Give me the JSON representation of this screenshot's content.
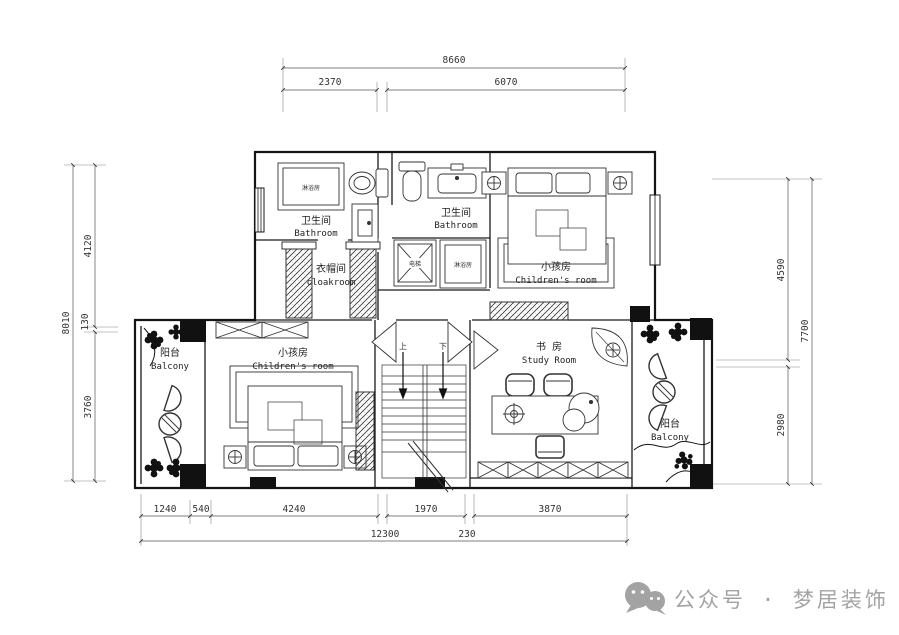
{
  "dims": {
    "top_total": "8660",
    "top_seg1": "2370",
    "top_seg2": "6070",
    "left_total": "8010",
    "left_seg1": "4120",
    "left_seg2": "130",
    "left_seg3": "3760",
    "right_total": "7700",
    "right_seg1": "4590",
    "right_seg2": "2980",
    "bot_seg1": "1240",
    "bot_seg2": "540",
    "bot_seg3": "4240",
    "bot_seg4": "1970",
    "bot_seg5": "3870",
    "bot_total": "12300",
    "bot_small": "230"
  },
  "rooms": {
    "bathroom1_zh": "卫生间",
    "bathroom1_en": "Bathroom",
    "bathroom2_zh": "卫生间",
    "bathroom2_en": "Bathroom",
    "cloakroom_zh": "衣帽间",
    "cloakroom_en": "cloakroom",
    "children1_zh": "小孩房",
    "children1_en": "Children's room",
    "children2_zh": "小孩房",
    "children2_en": "Children's room",
    "study_zh": "书 房",
    "study_en": "Study Room",
    "balcony_left_zh": "阳台",
    "balcony_left_en": "Balcony",
    "balcony_right_zh": "阳台",
    "balcony_right_en": "Balcony",
    "shower1": "淋浴房",
    "shower2": "淋浴房",
    "elevator": "电梯",
    "stair_up": "上",
    "stair_down": "下"
  },
  "watermark": {
    "label": "公众号 · 梦居装饰"
  }
}
